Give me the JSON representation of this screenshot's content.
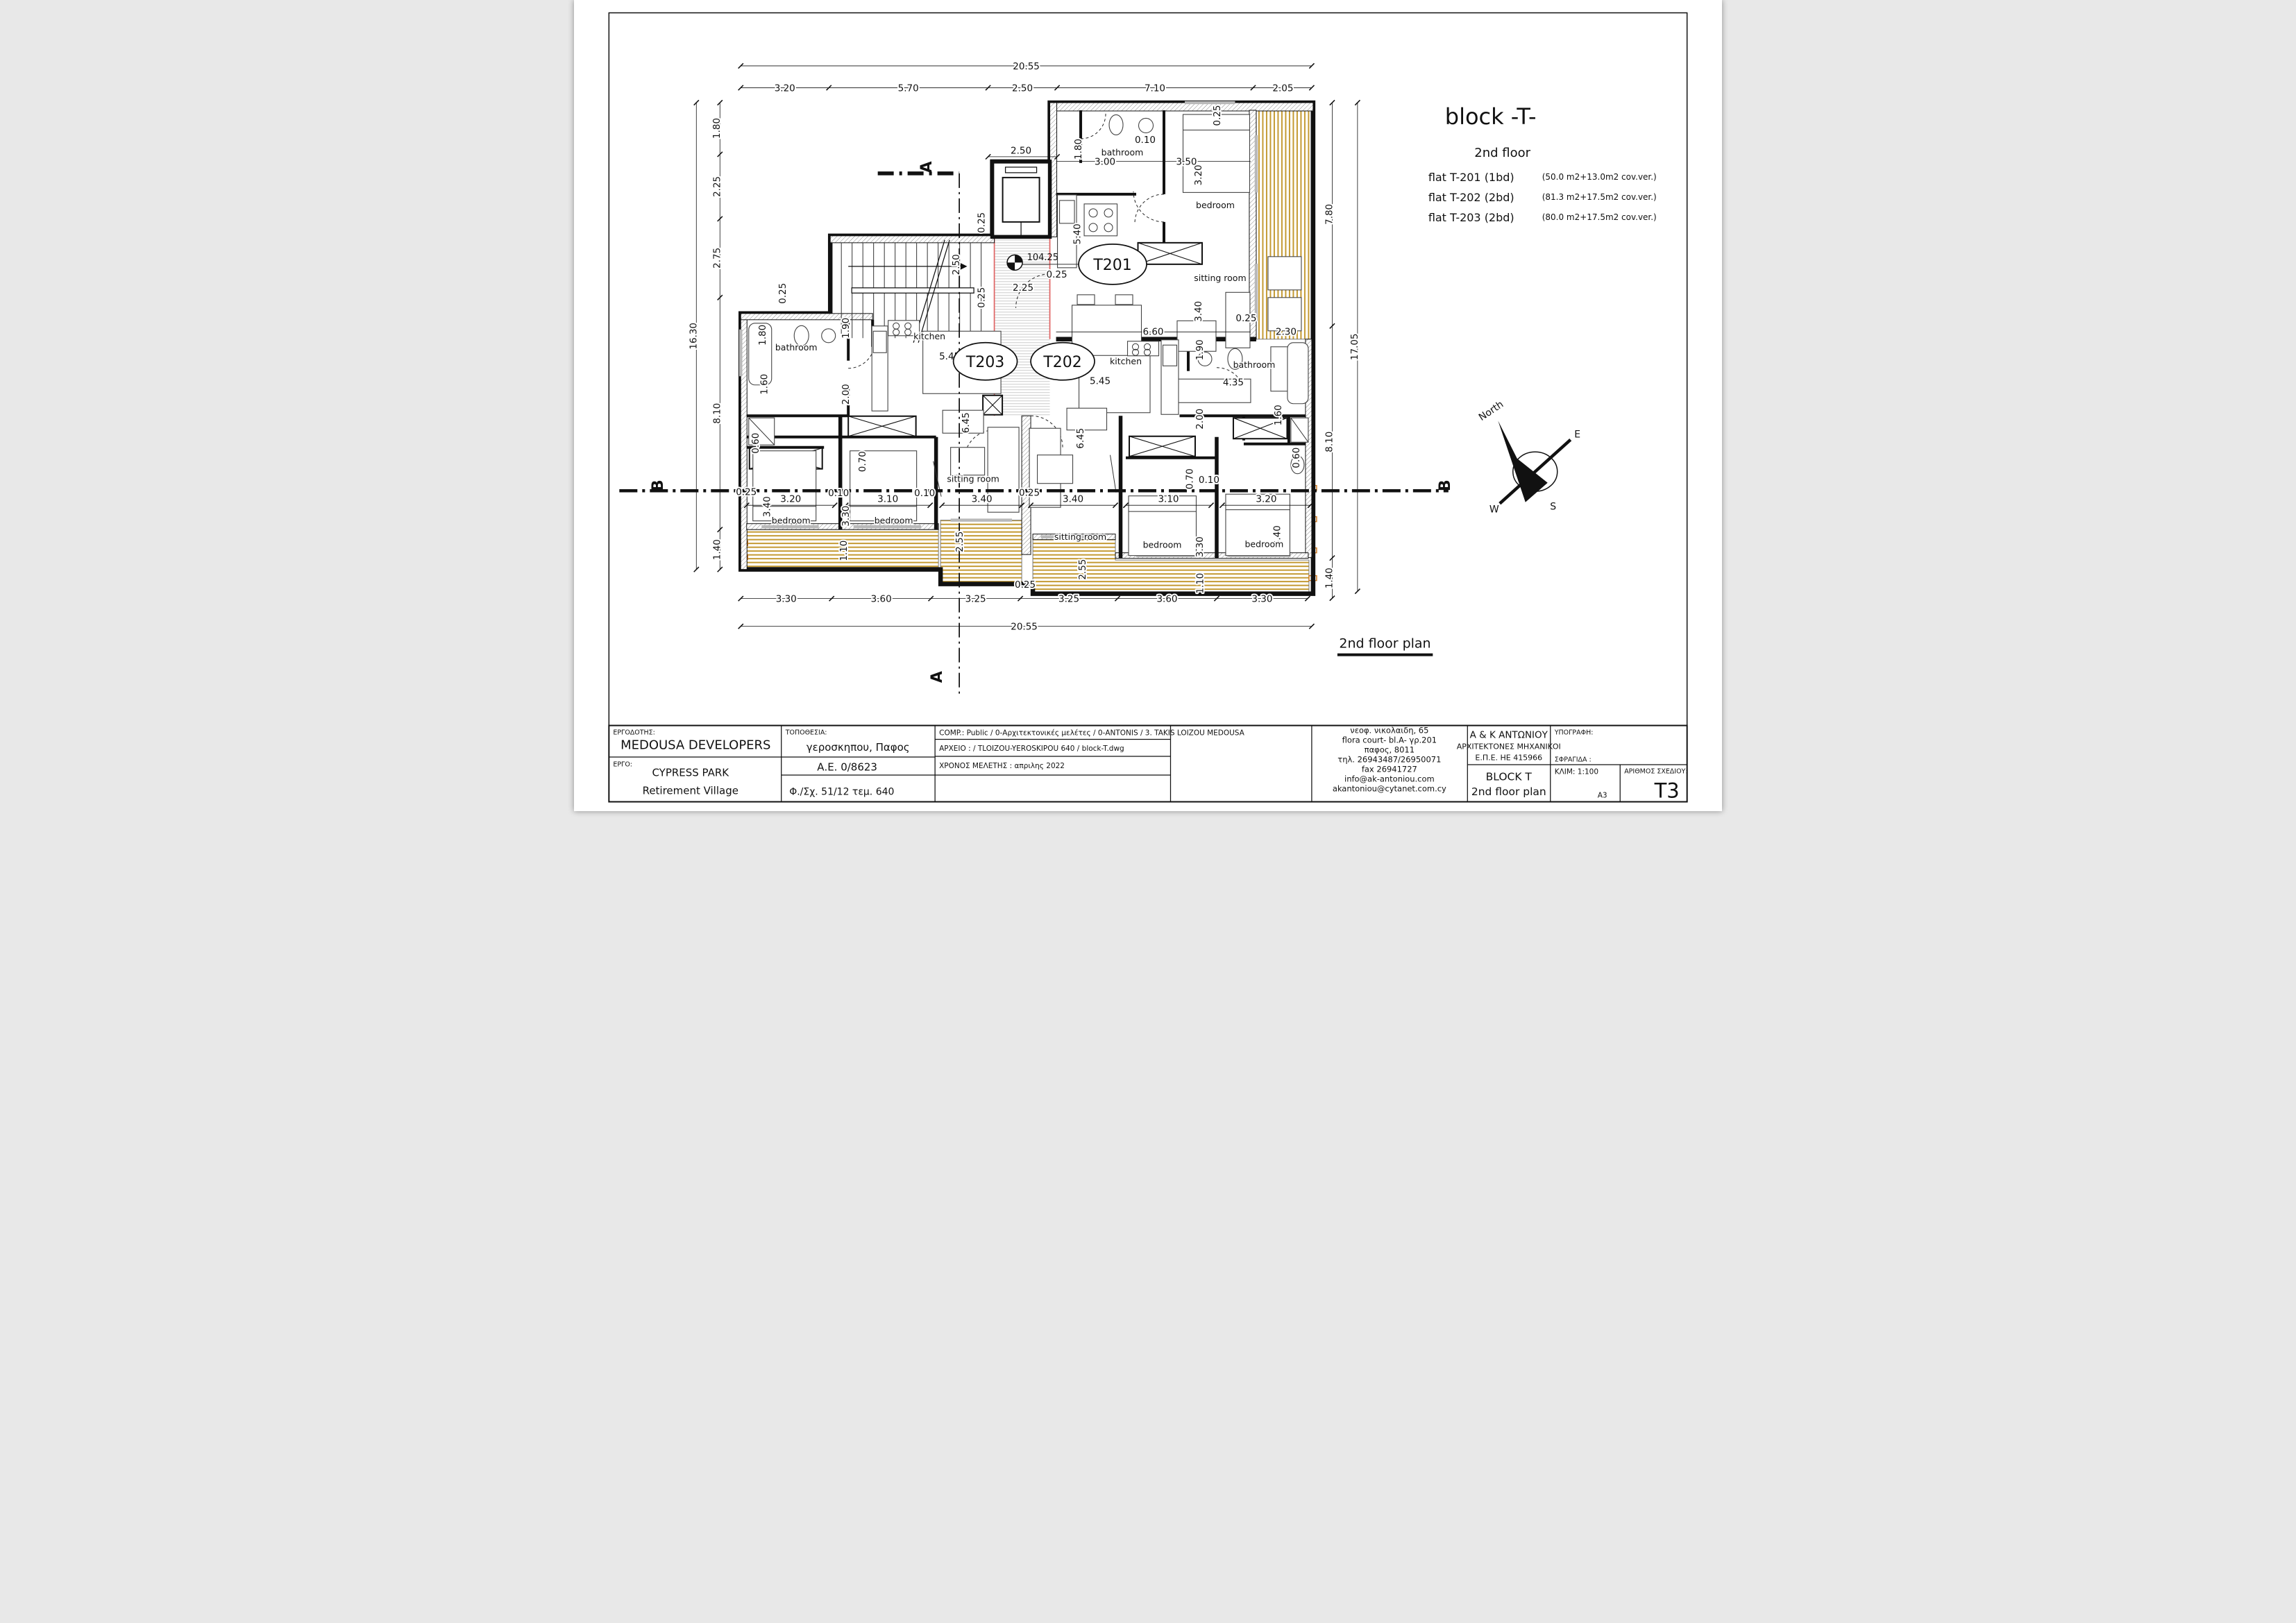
{
  "header": {
    "block_title": "block  -T-",
    "floor_label": "2nd floor",
    "flats": [
      {
        "name": "flat T-201 (1bd)",
        "area": "(50.0 m2+13.0m2 cov.ver.)"
      },
      {
        "name": "flat T-202 (2bd)",
        "area": "(81.3 m2+17.5m2 cov.ver.)"
      },
      {
        "name": "flat T-203 (2bd)",
        "area": "(80.0 m2+17.5m2 cov.ver.)"
      }
    ]
  },
  "plan": {
    "caption": "2nd floor plan",
    "level_label": "104.25",
    "flat_tags": [
      "T201",
      "T203",
      "T202"
    ],
    "rooms": [
      "bathroom",
      "bedroom",
      "sitting room",
      "bathroom",
      "kitchen",
      "sitting room",
      "bedroom",
      "bedroom",
      "kitchen",
      "bathroom",
      "sitting room",
      "bedroom",
      "bedroom"
    ],
    "sections": {
      "a": "A",
      "b": "B"
    },
    "compass": {
      "north": "North",
      "e": "E",
      "w": "W",
      "s": "S"
    },
    "colors": {
      "veranda": "#c49a33",
      "accent": "#e06666"
    },
    "dims": {
      "top_total": "20.55",
      "top": [
        "3.20",
        "5.70",
        "2.50",
        "7.10",
        "2.05"
      ],
      "left_total": "16.30",
      "left": [
        "1.80",
        "2.25",
        "2.75",
        "8.10",
        "1.40"
      ],
      "right_total": "17.05",
      "right": [
        "7.80",
        "8.10",
        "1.40"
      ],
      "bottom": [
        "3.30",
        "3.60",
        "3.25",
        "3.25",
        "3.60",
        "3.30"
      ],
      "bottom_total": "20.55",
      "bottom_offset": "0.25",
      "bedroom_row": [
        "3.20",
        "3.10",
        "3.40",
        "3.40",
        "3.10",
        "3.20"
      ],
      "inner": [
        "2.50",
        "1.80",
        "3.00",
        "0.10",
        "3.50",
        "3.20",
        "0.25",
        "5.40",
        "0.25",
        "2.25",
        "2.50",
        "6.60",
        "3.40",
        "0.25",
        "2.30",
        "0.25",
        "1.80",
        "1.90",
        "5.45",
        "1.60",
        "2.00",
        "0.60",
        "0.70",
        "0.25",
        "3.40",
        "0.10",
        "3.30",
        "0.10",
        "6.45",
        "0.25",
        "2.55",
        "1.10",
        "1.90",
        "5.45",
        "4.35",
        "2.00",
        "1.60",
        "0.60",
        "6.45",
        "0.70",
        "0.10",
        "3.30",
        "3.40",
        "2.55",
        "1.10",
        "0.25",
        "0.25"
      ]
    }
  },
  "titleblock": {
    "ergodotis_label": "ΕΡΓΟΔΟΤΗΣ:",
    "ergodotis": "MEDOUSA  DEVELOPERS",
    "ergo_label": "ΕΡΓΟ:",
    "ergo_line1": "CYPRESS PARK",
    "ergo_line2": "Retirement Village",
    "topothesia_label": "ΤΟΠΟΘΕΣΙΑ:",
    "topothesia": "γεροσκηπου, Παφος",
    "ae": "Α.Ε. 0/8623",
    "fsx": "Φ./Σχ. 51/12   τεμ. 640",
    "comp": "COMP.: Public / 0-Αρχιτεκτονικές μελέτες / 0-ANTONIS / 3. TAKIS LOIZOU MEDOUSA",
    "arxeio": "ΑΡΧΕΙΟ :   / TLOIZOU-YEROSKIPOU 640 / block-T.dwg",
    "xronos": "ΧΡΟΝΟΣ ΜΕΛΕΤΗΣ :   απριλης 2022",
    "address": [
      "νεοφ. νικολαιδη, 65",
      "flora court- bl.A- γρ.201",
      "παφος, 8011",
      "τηλ. 26943487/26950071",
      "fax  26941727",
      "info@ak-antoniou.com",
      "akantoniou@cytanet.com.cy"
    ],
    "firm_line1": "A & K ΑΝΤΩΝΙΟΥ",
    "firm_line2": "ΑΡΧΙΤΕΚΤΟΝΕΣ ΜΗΧΑΝΙΚΟΙ",
    "firm_line3": "Ε.Π.Ε.    ΗΕ 415966",
    "ypografi_label": "ΥΠΟΓΡΑΦΗ:",
    "sfragida_label": "ΣΦΡΑΓΙΔΑ :",
    "block_label": "BLOCK T",
    "plan_label": "2nd floor plan",
    "klim_label": "ΚΛΙΜ: 1:100",
    "paper": "A3",
    "arithmos_label": "ΑΡΙΘΜΟΣ ΣΧΕΔΙΟΥ:",
    "sheet_no": "T3"
  }
}
